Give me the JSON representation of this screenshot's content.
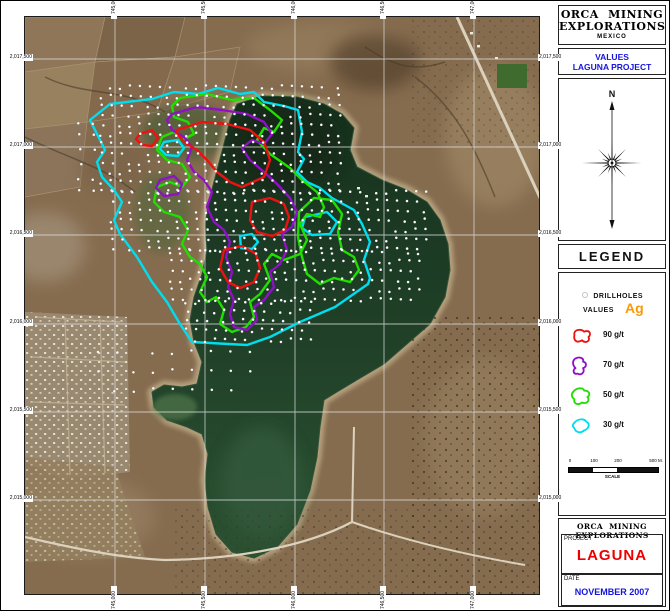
{
  "header": {
    "company_line1": "ORCA MINING",
    "company_line2": "EXPLORATIONS",
    "country": "MEXICO"
  },
  "map_title": {
    "line1": "VALUES",
    "line2": "LAGUNA PROJECT"
  },
  "compass": {
    "north_label": "N"
  },
  "legend": {
    "title": "LEGEND",
    "drillholes_label": "DRILLHOLES",
    "values_label": "VALUES",
    "element_symbol": "Ag",
    "element_color": "#ff9900",
    "entries": [
      {
        "label": "90 g/t",
        "color": "#ee1111",
        "icon": "M5,9 C4,4 11,3 14,6 C19,4 21,8 18,11 C20,15 15,17 12,14 C7,17 4,14 5,9 Z"
      },
      {
        "label": "70 g/t",
        "color": "#9010c8",
        "icon": "M6,3 C10,1 14,3 13,6 C17,7 16,11 13,12 C15,16 11,19 8,17 C4,18 3,14 6,12 C3,9 3,5 6,3 Z"
      },
      {
        "label": "50 g/t",
        "color": "#22dd00",
        "icon": "M4,6 C7,2 13,2 14,5 C19,5 20,9 17,11 C20,14 16,18 12,16 C8,19 4,17 5,13 C2,11 2,8 4,6 Z"
      },
      {
        "label": "30 g/t",
        "color": "#00ddee",
        "icon": "M5,7 C8,3 14,3 16,6 C20,8 18,13 14,14 C11,17 6,16 5,12 C3,10 3,9 5,7 Z"
      }
    ]
  },
  "scale_bar": {
    "tick_labels": [
      "0",
      "100",
      "200"
    ],
    "end_label": "500 M.",
    "caption": "SCALE"
  },
  "title_block": {
    "company": "ORCA MINING EXPLORATIONS",
    "project_label": "PROJECT",
    "project_name": "LAGUNA",
    "date_label": "DATE",
    "date_value": "NOVEMBER 2007"
  },
  "map": {
    "northing_labels": [
      "2,017,500",
      "2,017,000",
      "2,016,500",
      "2,016,000",
      "2,015,500",
      "2,015,000"
    ],
    "easting_labels": [
      "745,000",
      "745,500",
      "746,000",
      "746,500",
      "747,000"
    ],
    "grid_x": [
      90,
      180,
      270,
      359,
      449
    ],
    "grid_y": [
      42,
      130,
      218,
      307,
      395,
      483
    ],
    "contours": [
      {
        "value": "30 g/t",
        "color": "#00ddee",
        "paths": [
          "M65,103 L85,87 L127,82 L149,75 L173,77 L193,71 L215,77 L229,75 L239,85 L259,89 L273,93 L277,115 L273,135 L279,142 L272,155 L282,165 L295,171 L307,181 L329,193 L337,207 L345,225 L339,243 L345,261 L343,267 L310,290 L275,305 L245,320 L222,328 L167,325 L155,307 L142,285 L127,265 L112,240 L95,217 L89,203 L97,185 L89,173 L77,160 L72,145 L80,133 L74,121 Z",
          "M139,125 L153,123 L159,131 L153,139 L141,138 L135,132 Z",
          "M215,219 L227,217 L233,225 L227,232 L216,231 Z",
          "M280,200 L302,195 L312,205 L305,217 L287,218 L277,211 Z"
        ]
      },
      {
        "value": "50 g/t",
        "color": "#22dd00",
        "paths": [
          "M155,81 L182,77 L207,83 L229,81 L245,93 L257,103 L249,115 L239,111 L232,123 L245,137 L265,151 L277,163 L292,175 L299,190 L295,200 L282,197 L275,207 L282,223 L275,237 L259,243 L247,237 L239,247 L245,263 L235,277 L225,285 L229,300 L221,310 L207,315 L195,307 L199,293 L191,280 L182,285 L175,275 L182,260 L175,247 L165,240 L157,227 L163,213 L155,200 L139,195 L129,185 L132,170 L145,165 L157,170 L165,160 L157,147 L142,143 L132,133 L137,120 L149,115 L157,123 L169,117 L163,105 L149,100 L147,89 Z",
          "M274,195 L289,181 L307,183 L317,197 L313,215 L317,233 L329,240 L334,253 L325,265 L309,261 L295,267 L282,257 L277,240 L273,220 Z"
        ]
      },
      {
        "value": "70 g/t",
        "color": "#9010c8",
        "paths": [
          "M147,97 L172,90 L197,93 L222,97 L239,105 L247,117 L239,127 L227,123 L217,131 L225,143 L239,155 L252,167 L265,181 L272,195 L267,210 L257,217 L262,233 L255,247 L245,255 L249,270 L239,283 L229,290 L232,303 L222,313 L209,310 L205,297 L209,283 L203,270 L207,255 L201,240 L205,225 L199,213 L189,205 L182,190 L187,175 L179,163 L169,155 L162,143 L167,130 L159,120 L147,113 L142,103 Z",
          "M135,163 L149,159 L157,167 L153,177 L139,179 L131,171 Z"
        ]
      },
      {
        "value": "90 g/t",
        "color": "#ee1111",
        "paths": [
          "M152,113 L177,105 L202,107 L225,113 L239,125 L245,143 L239,160 L217,170 L205,165 L192,155 L182,143 L172,133 L159,125 L152,117 Z",
          "M115,117 L127,113 L133,121 L127,129 L117,128 L111,122 Z",
          "M227,185 L245,181 L259,187 L264,200 L260,213 L247,219 L232,215 L225,203 Z",
          "M199,233 L217,229 L231,237 L235,251 L229,265 L215,271 L203,265 L195,251 Z"
        ]
      }
    ],
    "drillhole_regions": [
      {
        "x0": 77,
        "y0": 70,
        "x1": 317,
        "y1": 175,
        "step": 9.5
      },
      {
        "x0": 87,
        "y0": 175,
        "x1": 407,
        "y1": 235,
        "step": 9.5
      },
      {
        "x0": 147,
        "y0": 235,
        "x1": 397,
        "y1": 285,
        "step": 9.5
      },
      {
        "x0": 162,
        "y0": 285,
        "x1": 287,
        "y1": 330,
        "step": 9.5
      },
      {
        "x0": 72,
        "y0": 335,
        "x1": 227,
        "y1": 390,
        "step": 19
      },
      {
        "x0": 55,
        "y0": 105,
        "x1": 77,
        "y1": 185,
        "step": 14
      }
    ]
  }
}
